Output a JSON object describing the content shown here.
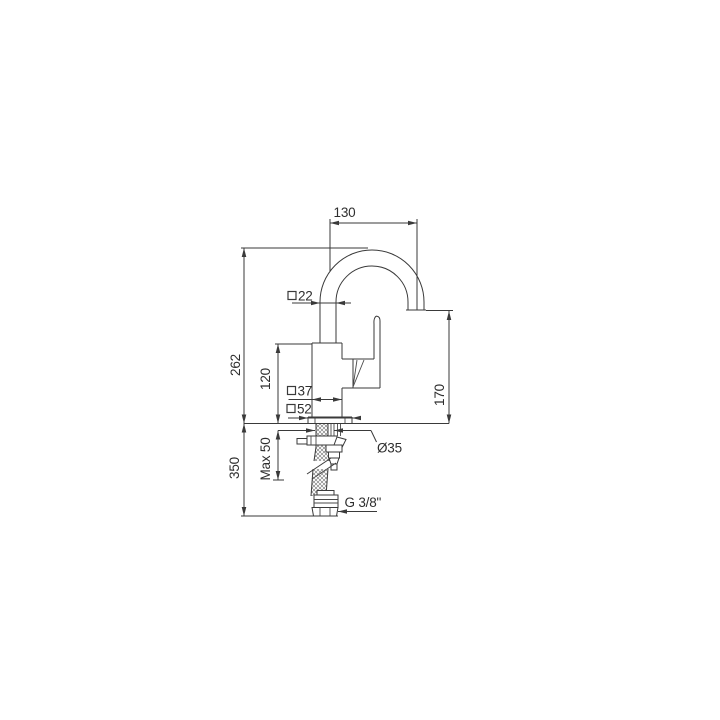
{
  "palette": {
    "background": "#ffffff",
    "line_color": "#3a3a3a",
    "text_color": "#2e2e2e"
  },
  "drawing": {
    "type": "technical-dimension-drawing",
    "dimensions": {
      "spout_reach": "130",
      "spout_tube_size": "22",
      "height_to_spout_top": "262",
      "height_to_body_top": "120",
      "body_size": "37",
      "base_size": "52",
      "spout_outlet_height": "170",
      "hole_diameter": "Ø35",
      "max_counter_thickness": "Max 50",
      "below_counter_length": "350",
      "supply_thread": "G 3/8\"",
      "square_symbol": "□"
    }
  }
}
